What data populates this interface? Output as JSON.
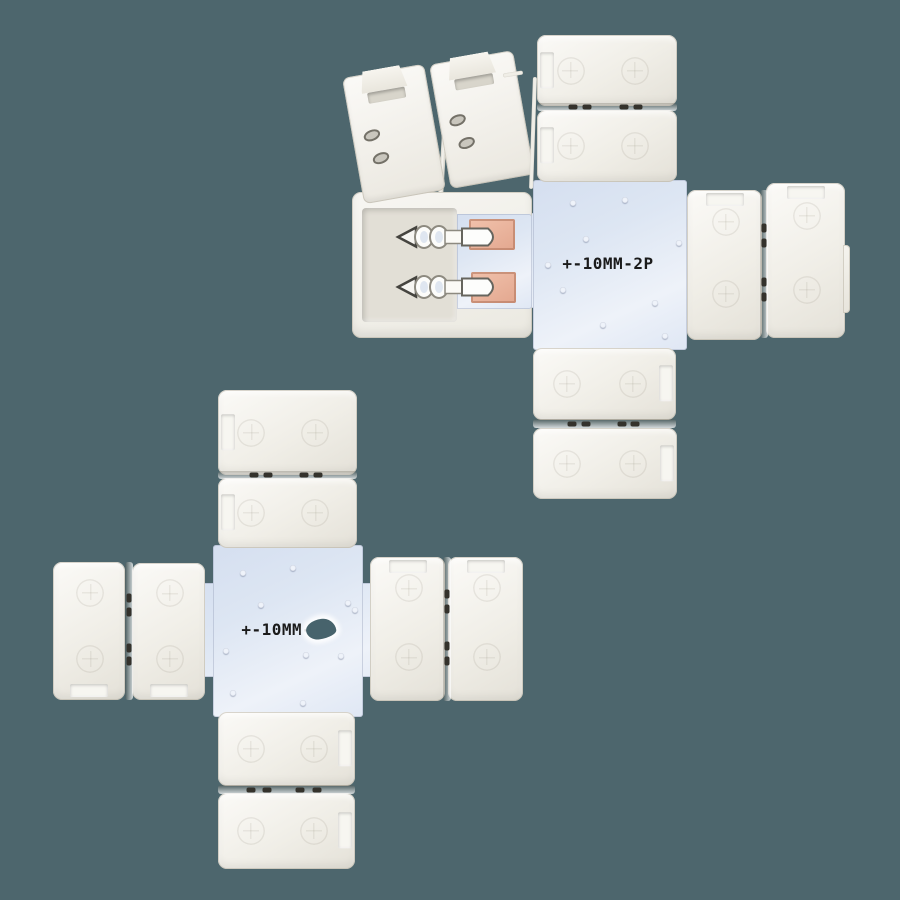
{
  "colors": {
    "background": "#4d666d",
    "clip-body": "#f0eee7",
    "pcb": "#dde6f3",
    "copper": "#e9b6a0",
    "metal": "#fdfdfb",
    "label": "#1b1b1b",
    "glare": "#47636c"
  },
  "assemblies": {
    "top_right": {
      "pcb_label": "+-10MM-2P",
      "polarity_mark": "+"
    },
    "bottom_left": {
      "pcb_label": "+-10MM-2P"
    }
  }
}
